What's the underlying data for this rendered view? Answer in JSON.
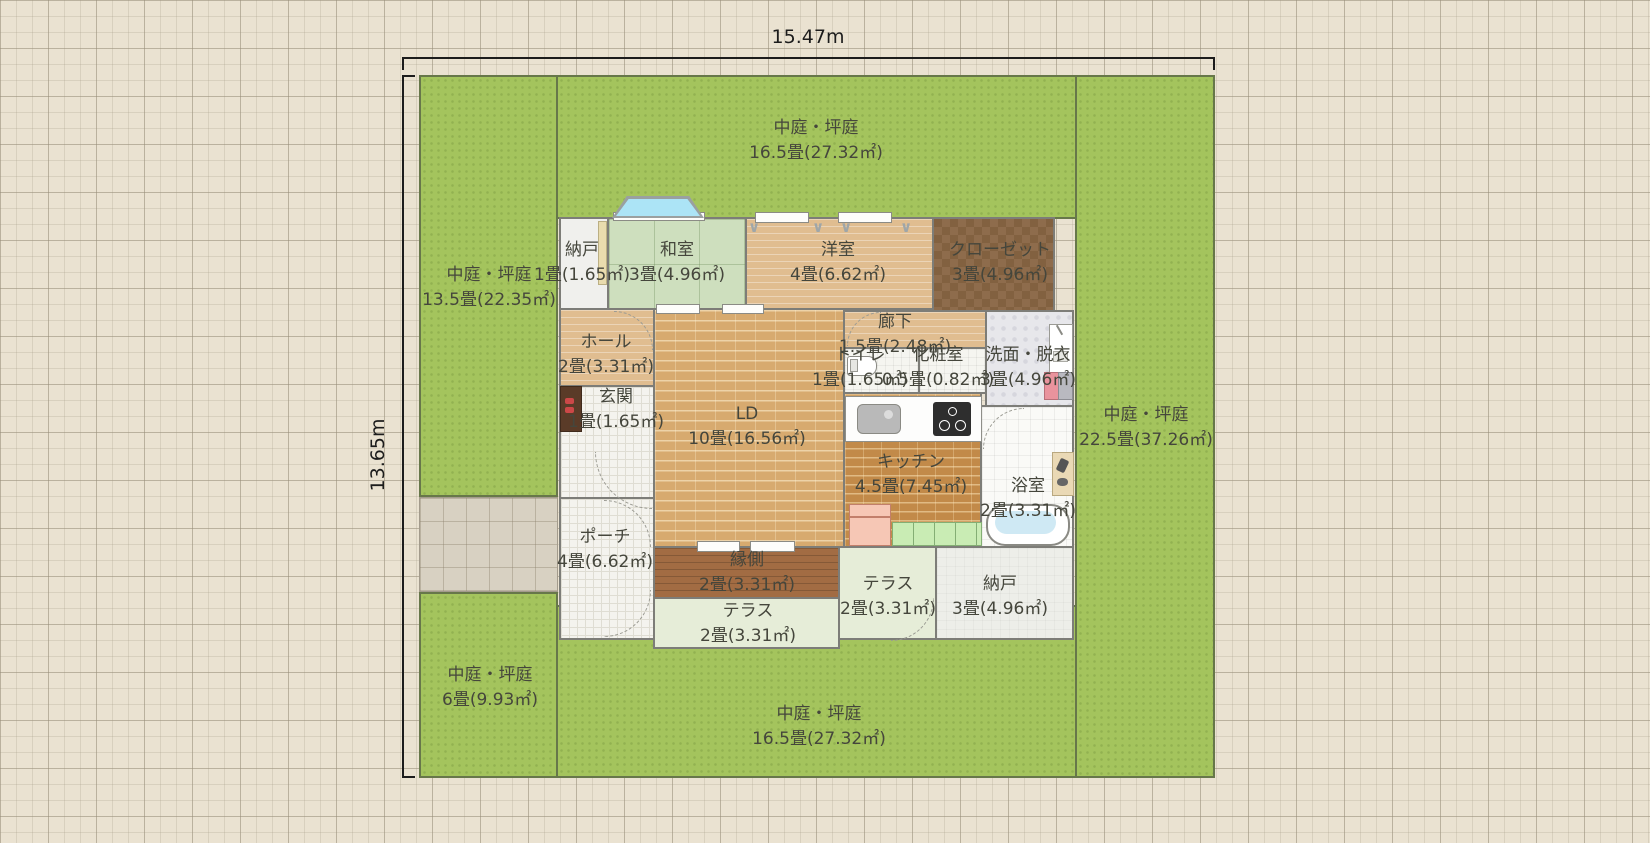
{
  "dims": {
    "width": "15.47m",
    "height": "13.65m"
  },
  "labels": {
    "g_top": {
      "name": "中庭・坪庭",
      "size": "16.5畳(27.32㎡)"
    },
    "g_left": {
      "name": "中庭・坪庭",
      "size": "13.5畳(22.35㎡)"
    },
    "g_right": {
      "name": "中庭・坪庭",
      "size": "22.5畳(37.26㎡)"
    },
    "g_bl": {
      "name": "中庭・坪庭",
      "size": "6畳(9.93㎡)"
    },
    "g_bottom": {
      "name": "中庭・坪庭",
      "size": "16.5畳(27.32㎡)"
    },
    "nando1": {
      "name": "納戸",
      "size": "1畳(1.65㎡)"
    },
    "washitsu": {
      "name": "和室",
      "size": "3畳(4.96㎡)"
    },
    "yoshitsu": {
      "name": "洋室",
      "size": "4畳(6.62㎡)"
    },
    "closet": {
      "name": "クローゼット",
      "size": "3畳(4.96㎡)"
    },
    "hall": {
      "name": "ホール",
      "size": "2畳(3.31㎡)"
    },
    "ld": {
      "name": "LD",
      "size": "10畳(16.56㎡)"
    },
    "rouka": {
      "name": "廊下",
      "size": "1.5畳(2.48㎡)"
    },
    "toilet": {
      "name": "トイレ",
      "size": "1畳(1.65㎡)"
    },
    "keshou": {
      "name": "化粧室",
      "size": "0.5畳(0.82㎡)"
    },
    "senmen": {
      "name": "洗面・脱衣",
      "size": "3畳(4.96㎡)"
    },
    "kitchen": {
      "name": "キッチン",
      "size": "4.5畳(7.45㎡)"
    },
    "bath": {
      "name": "浴室",
      "size": "2畳(3.31㎡)"
    },
    "genkan": {
      "name": "玄関",
      "size": "1畳(1.65㎡)"
    },
    "porch": {
      "name": "ポーチ",
      "size": "4畳(6.62㎡)"
    },
    "engawa": {
      "name": "縁側",
      "size": "2畳(3.31㎡)"
    },
    "terrace_c": {
      "name": "テラス",
      "size": "2畳(3.31㎡)"
    },
    "terrace_r": {
      "name": "テラス",
      "size": "2畳(3.31㎡)"
    },
    "nando2": {
      "name": "納戸",
      "size": "3畳(4.96㎡)"
    }
  },
  "icons": {
    "closet_hanger": "∨"
  },
  "colors": {
    "canvas_bg": "#EAE2D1",
    "garden_green": "#A4C45D",
    "driveway_gray": "#D8D1C2",
    "wall_gray": "#7D7D78",
    "tatami_green": "#CEDFBE",
    "wood_light": "#E0BD90",
    "ld_brick": "#D7AA6F",
    "kitchen_brick": "#C28A49",
    "engawa_wood": "#A26C43",
    "closet_brown": "#8E6C4C",
    "terrace_pale": "#E6EDD8",
    "bay_window_glass": "#ACE4F6",
    "bathtub_water": "#CFE9F4",
    "fridge_pink": "#F6C7B5",
    "cabinet_green": "#C9ECB4",
    "label_text": "#45463C"
  }
}
